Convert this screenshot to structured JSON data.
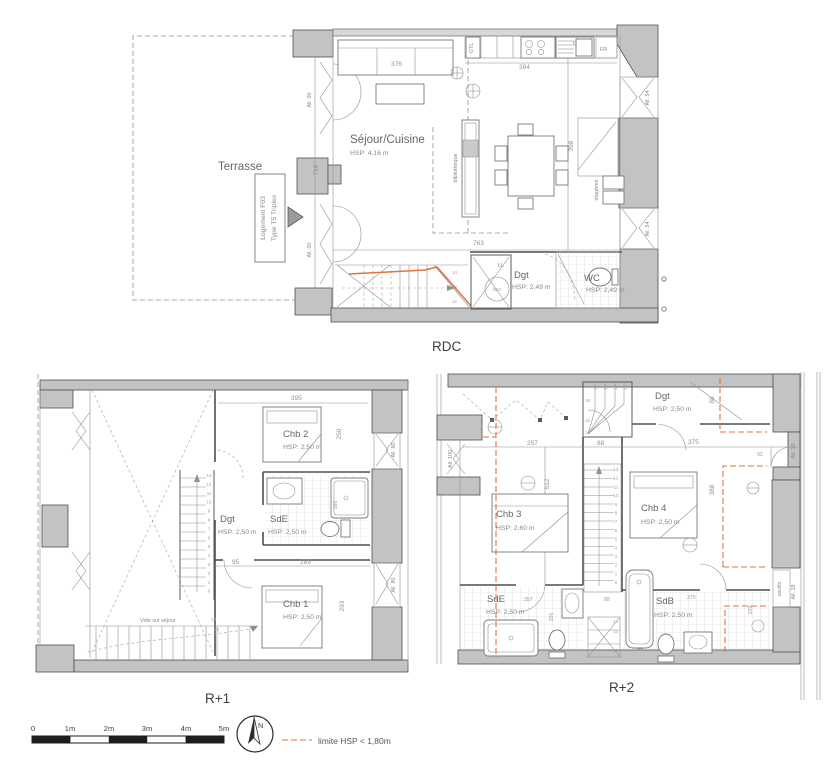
{
  "sheet": {
    "rdc_title": "RDC",
    "r1_title": "R+1",
    "r2_title": "R+2"
  },
  "legend": {
    "limit_label": "limite HSP < 1,80m",
    "north": "N",
    "scale_ticks": [
      "0",
      "1m",
      "2m",
      "3m",
      "4m",
      "5m"
    ]
  },
  "rdc": {
    "terrasse": "Terrasse",
    "tag_line1": "Logement F03",
    "tag_line2": "Type T5 Triplex",
    "sejour": "Séjour/Cuisine",
    "sejour_hsp": "HSP: 4,16 m",
    "dgt": "Dgt",
    "dgt_hsp": "HSP: 2,49 m",
    "wc": "WC",
    "wc_hsp": "HSP: 2,49 m",
    "gtl": "GTL",
    "fr": "FR",
    "ll": "LL",
    "sec": "SEC",
    "bibliotheque": "bibliothèque",
    "etageres": "étagères",
    "dim_376": "376",
    "dim_384": "384",
    "dim_718": "718",
    "dim_763": "763",
    "dim_398": "398",
    "all_00": "All. 00",
    "all_54": "All. 54",
    "steps": [
      "14",
      "13",
      "12"
    ]
  },
  "r1": {
    "chb2": "Chb 2",
    "chb2_hsp": "HSP: 2,50 m",
    "chb1": "Chb 1",
    "chb1_hsp": "HSP: 2,50 m",
    "dgt": "Dgt",
    "dgt_hsp": "HSP: 2,50 m",
    "sde": "SdE",
    "sde_hsp": "HSP: 2,50 m",
    "vide": "Vide sur séjour",
    "all_80": "All. 80",
    "dim_395": "395",
    "dim_250": "250",
    "dim_95": "95",
    "dim_289": "289",
    "dim_293": "293",
    "dim_160": "160",
    "stair_steps": [
      "13",
      "12",
      "11",
      "10",
      "9",
      "8",
      "7",
      "6",
      "5",
      "4",
      "3",
      "2",
      "1",
      "0"
    ],
    "lower_steps": [
      "14",
      "13"
    ]
  },
  "r2": {
    "dgt": "Dgt",
    "dgt_hsp": "HSP: 2,50 m",
    "chb3": "Chb 3",
    "chb3_hsp": "HSP: 2,60 m",
    "chb4": "Chb 4",
    "chb4_hsp": "HSP: 2,50 m",
    "sde": "SdE",
    "sde_hsp": "HSP: 2,50 m",
    "sdb": "SdB",
    "sdb_hsp": "HSP: 2,50 m",
    "all_100": "All. 100",
    "all_18": "All. 18",
    "oscillo": "oscillo",
    "dim_257": "257",
    "dim_88": "88",
    "dim_375": "375",
    "dim_92": "92",
    "dim_388": "388",
    "dim_512": "512",
    "dim_200": "200",
    "dim_229": "229",
    "stair_steps": [
      "13",
      "12",
      "11",
      "10",
      "9",
      "8",
      "7",
      "6",
      "5",
      "4",
      "3",
      "2",
      "1",
      "0"
    ],
    "winder_steps": [
      "16",
      "15",
      "14"
    ],
    "winder_top_steps": [
      "17",
      "18",
      "19",
      "20"
    ],
    "lower_steps": [
      "14",
      "13",
      "12"
    ]
  }
}
